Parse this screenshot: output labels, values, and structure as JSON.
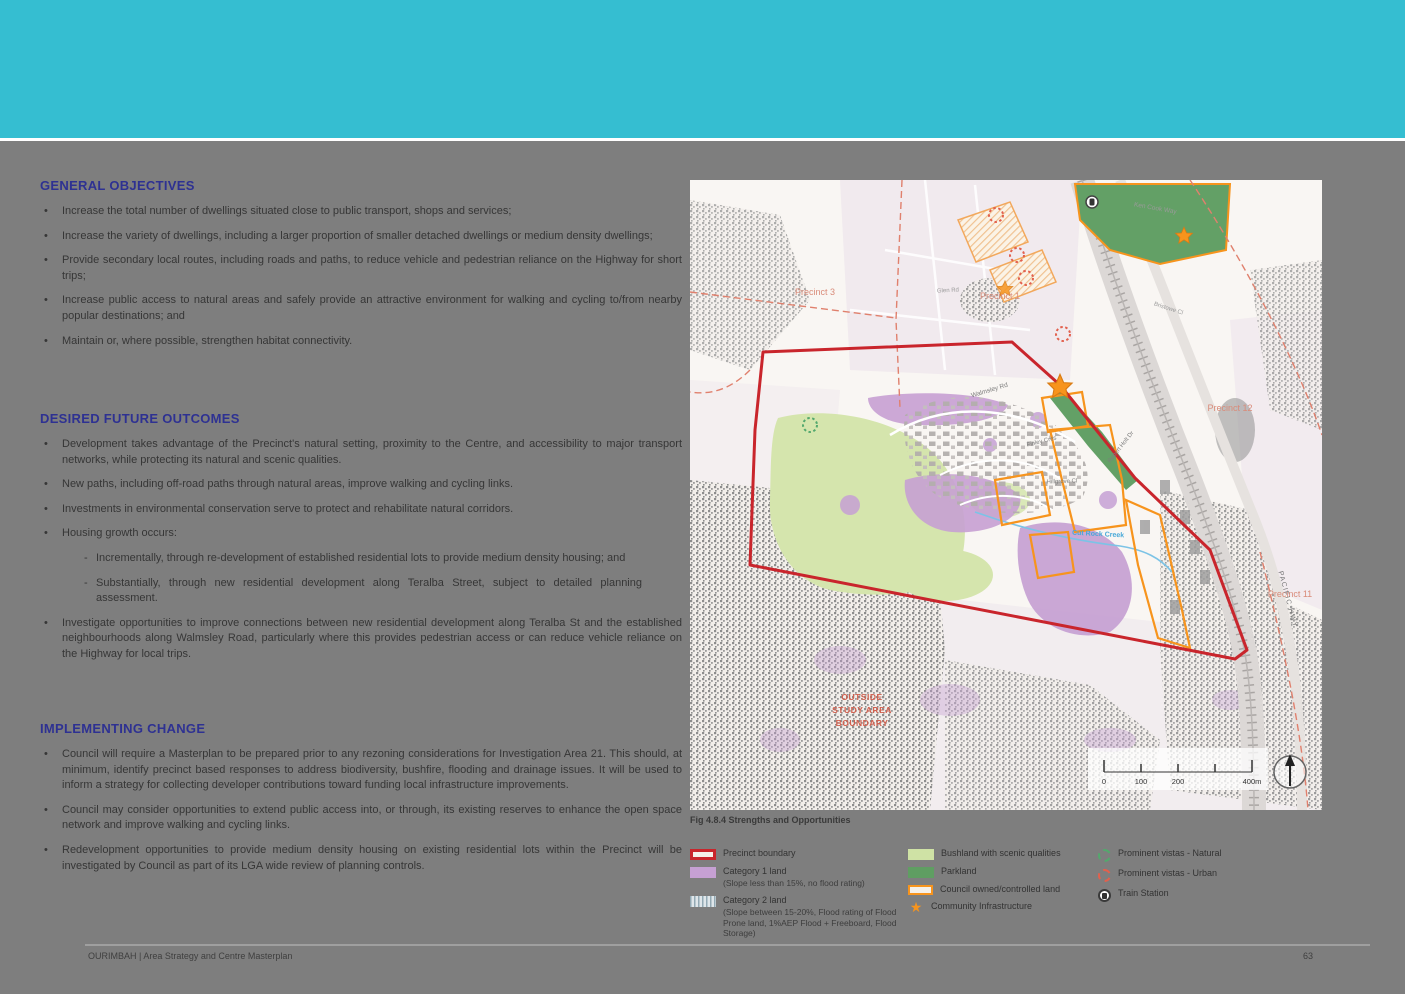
{
  "colors": {
    "header_teal": "#35bed1",
    "page_gray": "#7e7e7e",
    "heading_blue": "#2e3192",
    "boundary_red": "#c9252c",
    "category1_purple": "#c6a0d3",
    "bushland_green": "#cfe2a5",
    "parkland_green": "#5f9e62",
    "council_orange": "#f7941d"
  },
  "sections": {
    "general": {
      "title": "GENERAL OBJECTIVES",
      "bullets": [
        "Increase the total number of dwellings situated close to public transport, shops and services;",
        "Increase the variety of dwellings, including a larger proportion of smaller detached dwellings or medium density dwellings;",
        "Provide secondary local routes, including roads and paths, to reduce vehicle and pedestrian reliance on the Highway for short trips;",
        "Increase public access to natural areas and safely provide an attractive environment for walking and cycling to/from nearby popular destinations; and",
        "Maintain or, where possible, strengthen habitat connectivity."
      ]
    },
    "desired": {
      "title": "DESIRED FUTURE OUTCOMES",
      "bullets": [
        "Development takes advantage of the Precinct's natural setting, proximity to the Centre, and accessibility to major transport networks, while protecting its natural and scenic qualities.",
        "New paths, including off-road paths through natural areas, improve walking and cycling links.",
        "Investments in environmental conservation serve to protect and rehabilitate natural corridors.",
        "Housing growth occurs:"
      ],
      "sub_bullets": [
        "Incrementally, through re-development of established residential lots to provide medium density housing; and",
        "Substantially, through new residential development along Teralba Street, subject to detailed planning assessment."
      ],
      "more_bullets": [
        "Investigate opportunities to improve connections between new residential development along Teralba St and the established neighbourhoods along Walmsley Road, particularly where this provides pedestrian access or can reduce vehicle reliance on the Highway for local trips."
      ]
    },
    "implementing": {
      "title": "IMPLEMENTING CHANGE",
      "bullets": [
        "Council will require a Masterplan to be prepared prior to any rezoning considerations for Investigation Area 21. This should, at minimum, identify precinct based responses to address biodiversity, bushfire, flooding and drainage issues. It will be used to inform a strategy for collecting developer contributions toward funding local infrastructure improvements.",
        "Council may consider opportunities to extend public access into, or through, its existing reserves to enhance the open space network and improve walking and cycling links.",
        "Redevelopment opportunities to provide medium density housing on existing residential lots within the Precinct will be investigated by Council as part of its LGA wide review of planning controls."
      ]
    }
  },
  "map": {
    "caption": "Fig 4.8.4 Strengths and Opportunities",
    "labels": {
      "precinct3": "Precinct 3",
      "precinct1": "Precinct 1",
      "precinct12": "Precinct 12",
      "precinct11": "Precinct 11",
      "ken_cook_way": "Ken Cook Way",
      "glen_rd": "Glen Rd",
      "bristowe_cl": "Bristowe Cl",
      "walmsley_rd": "Walmsley Rd",
      "finley_cres": "Finley Cres",
      "robert_holt_dr": "Robert Holt Dr",
      "hillgrove_cl": "Hillgrove Cl",
      "cut_rock_creek": "Cut Rock Creek",
      "pacific_hwy": "PACIFIC HWY",
      "outside_1": "OUTSIDE",
      "outside_2": "STUDY AREA",
      "outside_3": "BOUNDARY",
      "scale_0": "0",
      "scale_100": "100",
      "scale_200": "200",
      "scale_400": "400m"
    }
  },
  "legend": {
    "precinct_boundary": "Precinct boundary",
    "category1_label": "Category 1 land",
    "category1_sub": "(Slope less than 15%, no flood rating)",
    "category2_label": "Category 2 land",
    "category2_sub": "(Slope between 15-20%, Flood rating of Flood Prone land, 1%AEP Flood + Freeboard, Flood Storage)",
    "bushland": "Bushland with scenic qualities",
    "parkland": "Parkland",
    "council_land": "Council owned/controlled land",
    "community_infrastructure": "Community Infrastructure",
    "vistas_natural": "Prominent vistas - Natural",
    "vistas_urban": "Prominent vistas - Urban",
    "train_station": "Train Station",
    "star_glyph": "★"
  },
  "footer": {
    "left": "OURIMBAH  |  Area Strategy and Centre Masterplan",
    "page_number": "63"
  }
}
